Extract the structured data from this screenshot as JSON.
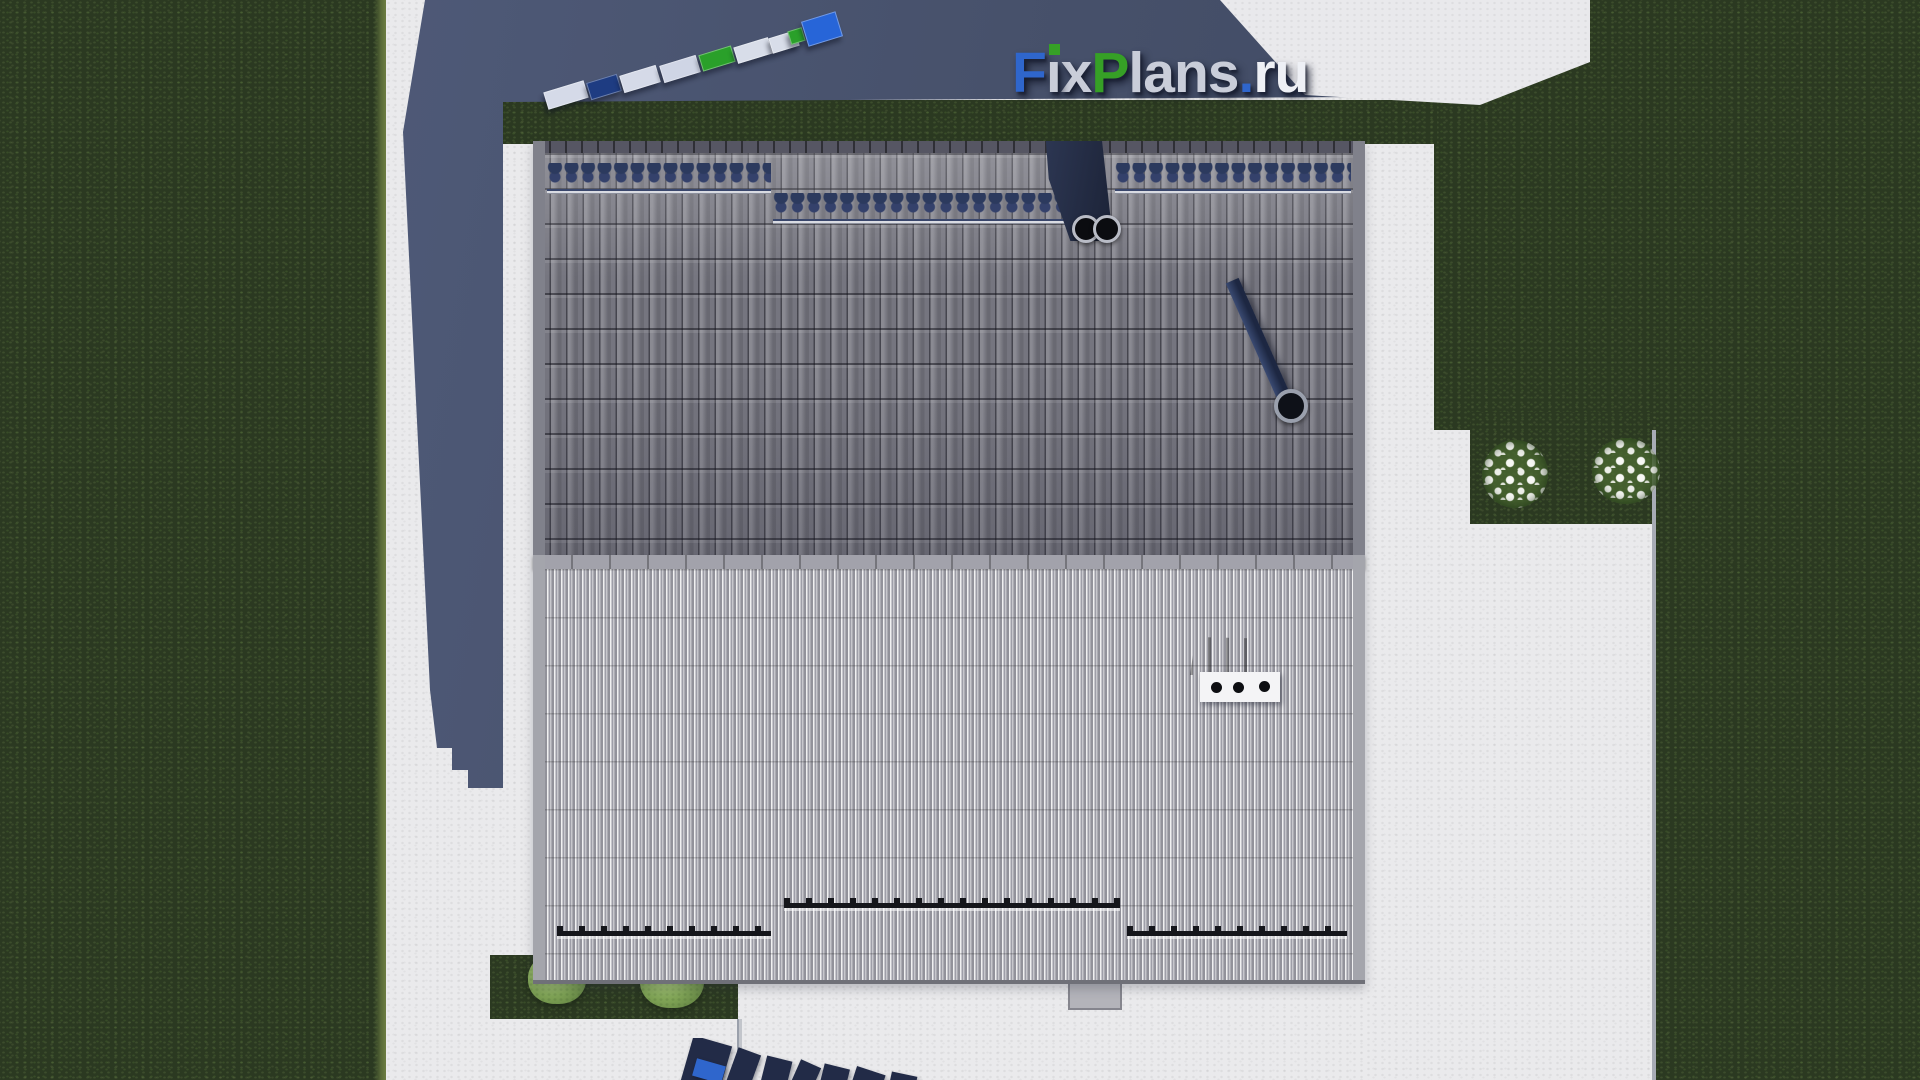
{
  "site": {
    "name": "FixPlans.ru"
  },
  "logo": {
    "part_f": "F",
    "part_i": "ı",
    "part_x": "x",
    "part_p": "P",
    "part_lans": "lans",
    "part_dot": ".",
    "part_ru": "ru",
    "full_text": "FixPlans.ru",
    "colors": {
      "blue": "#2f66cc",
      "green": "#36a026",
      "silver": "#c9cdd9",
      "white": "#eef0f5"
    }
  },
  "scene": {
    "setting": "Top-down 3D architectural render of a gable-roof house on a landscaped plot",
    "house": {
      "upper_roof": "dark gray barrel roof tiles",
      "lower_roof": "light gray ribbed roof sheets",
      "chimney_flues": 2,
      "snow_guard_wave_rows": 3,
      "snow_guard_rails": 3,
      "roof_vent_outlets": 3,
      "diagonal_pipe": "dark pipe with round outlet on upper roof slope"
    },
    "yard": {
      "lawn_color": "#2b3921",
      "path_color": "#eaeaec",
      "shadow_color": "#47516b",
      "flower_bushes": 2,
      "green_bushes": 2
    },
    "packages": [
      {
        "name": "package-1",
        "color": "#d5dae8"
      },
      {
        "name": "package-2",
        "color": "#1e3c82"
      },
      {
        "name": "package-3",
        "color": "#d5dae8"
      },
      {
        "name": "package-4",
        "color": "#cfd5e5"
      },
      {
        "name": "package-5",
        "color": "#2aa02a"
      },
      {
        "name": "package-6",
        "color": "#d8dde9"
      },
      {
        "name": "package-7",
        "color": "#d8dde9"
      },
      {
        "name": "package-8",
        "color": "#2aa02a"
      },
      {
        "name": "package-9",
        "color": "#2765d8"
      }
    ]
  }
}
